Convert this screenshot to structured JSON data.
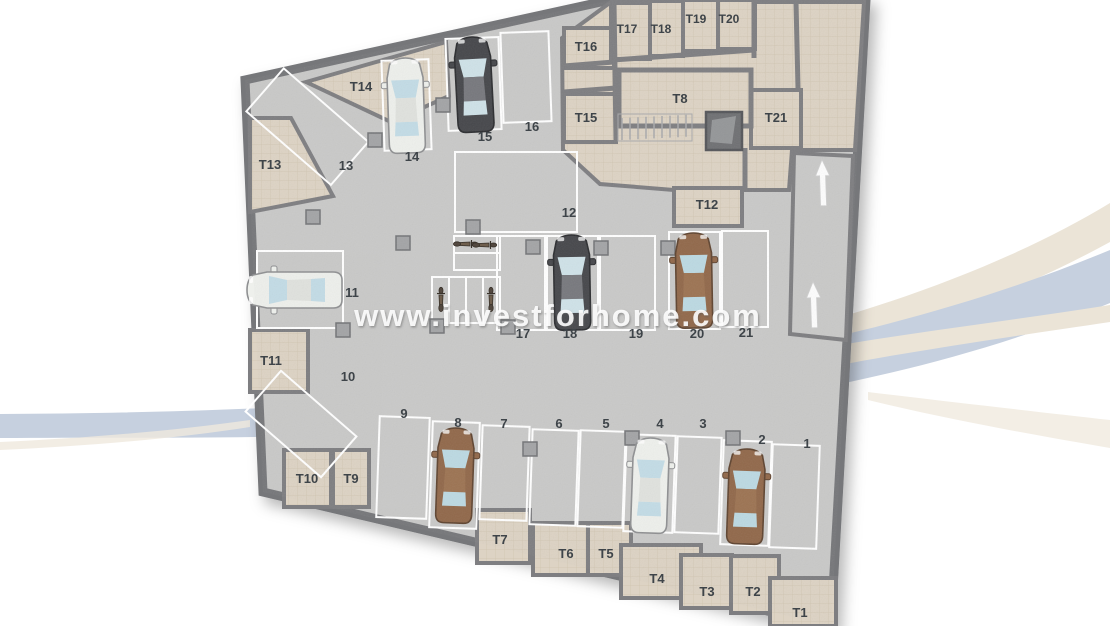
{
  "watermark": {
    "text": "www.investforhome.com"
  },
  "floor_plan": {
    "name": "underground parking garage floor plan",
    "parking_spots": [
      {
        "number": "1",
        "vehicle": "none"
      },
      {
        "number": "2",
        "vehicle": "brown car"
      },
      {
        "number": "3",
        "vehicle": "none"
      },
      {
        "number": "4",
        "vehicle": "white car"
      },
      {
        "number": "5",
        "vehicle": "none"
      },
      {
        "number": "6",
        "vehicle": "none"
      },
      {
        "number": "7",
        "vehicle": "none"
      },
      {
        "number": "8",
        "vehicle": "brown car"
      },
      {
        "number": "9",
        "vehicle": "none"
      },
      {
        "number": "10",
        "vehicle": "none"
      },
      {
        "number": "11",
        "vehicle": "white car"
      },
      {
        "number": "12",
        "vehicle": "none"
      },
      {
        "number": "13",
        "vehicle": "none"
      },
      {
        "number": "14",
        "vehicle": "white car"
      },
      {
        "number": "15",
        "vehicle": "dark gray car"
      },
      {
        "number": "16",
        "vehicle": "none"
      },
      {
        "number": "17",
        "vehicle": "none"
      },
      {
        "number": "18",
        "vehicle": "dark gray car"
      },
      {
        "number": "19",
        "vehicle": "none"
      },
      {
        "number": "20",
        "vehicle": "brown car"
      },
      {
        "number": "21",
        "vehicle": "none"
      }
    ],
    "storage_rooms": [
      {
        "label": "T1"
      },
      {
        "label": "T2"
      },
      {
        "label": "T3"
      },
      {
        "label": "T4"
      },
      {
        "label": "T5"
      },
      {
        "label": "T6"
      },
      {
        "label": "T7"
      },
      {
        "label": "T8"
      },
      {
        "label": "T9"
      },
      {
        "label": "T10"
      },
      {
        "label": "T11"
      },
      {
        "label": "T12"
      },
      {
        "label": "T13"
      },
      {
        "label": "T14"
      },
      {
        "label": "T15"
      },
      {
        "label": "T16"
      },
      {
        "label": "T17"
      },
      {
        "label": "T18"
      },
      {
        "label": "T19"
      },
      {
        "label": "T20"
      },
      {
        "label": "T21"
      }
    ],
    "motorcycles_parked": 4,
    "ramp_arrows": 2,
    "features": [
      "stairs",
      "elevator",
      "ramp"
    ]
  },
  "colors": {
    "floor": "#c9c9c8",
    "walls": "#76777a",
    "storage_floor": "#ddd3c4",
    "spot_lines": "#ffffff",
    "label_text": "#3e4449",
    "swoosh_blue": "#c6d0df",
    "swoosh_cream": "#ebe4d7",
    "car_white": "#eef0ec",
    "car_dark": "#46474b",
    "car_brown": "#91684a"
  }
}
